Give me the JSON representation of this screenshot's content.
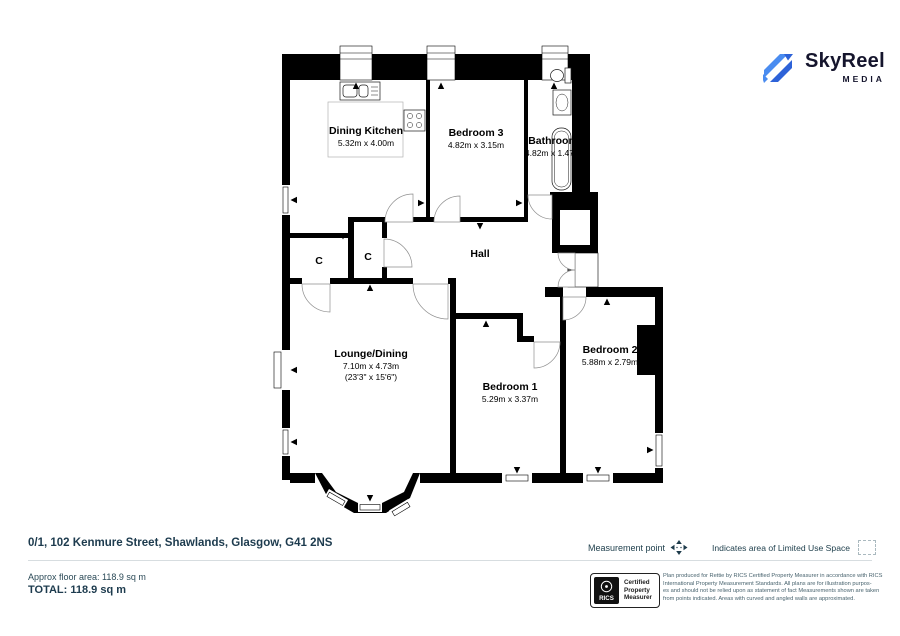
{
  "logo": {
    "brand": "SkyReel",
    "sub": "MEDIA"
  },
  "plan": {
    "dining_kitchen": {
      "name": "Dining Kitchen",
      "dims": "5.32m x 4.00m"
    },
    "bedroom_3": {
      "name": "Bedroom 3",
      "dims": "4.82m x 3.15m"
    },
    "bathroom": {
      "name": "Bathroom",
      "dims": "4.82m x 1.47m"
    },
    "hall": {
      "name": "Hall"
    },
    "cupboard_left": {
      "label": "C"
    },
    "cupboard_right": {
      "label": "C"
    },
    "lounge_dining": {
      "name": "Lounge/Dining",
      "dims": "7.10m x 4.73m",
      "dims_imperial": "(23'3\" x 15'6\")"
    },
    "bedroom_1": {
      "name": "Bedroom 1",
      "dims": "5.29m x 3.37m"
    },
    "bedroom_2": {
      "name": "Bedroom 2",
      "dims": "5.88m x 2.79m"
    }
  },
  "footer": {
    "address": "0/1, 102 Kenmure Street, Shawlands, Glasgow, G41 2NS",
    "approx_area": "Approx floor area: 118.9 sq m",
    "total": "TOTAL: 118.9 sq m",
    "legend": {
      "measurement_point": "Measurement point",
      "limited_use": "Indicates area of  Limited Use Space"
    },
    "rics_badge": {
      "brand": "RICS",
      "lines": [
        "Certified",
        "Property",
        "Measurer"
      ]
    },
    "disclaimer": [
      "Plan produced for Rettie by RICS Certified Property Measurer in accordance with RICS",
      "International Property  Measurement Standards.  All plans are for illustration purpos-",
      "es and should not be relied upon as statement of fact Measurements shown are taken",
      "from points indicated. Areas with curved and angled walls are approximated."
    ]
  },
  "colors": {
    "logo_blue_light": "#4a8cf0",
    "logo_blue_dark": "#2d62d8",
    "logo_text": "#15152d",
    "wall_black": "#000000",
    "footer_text": "#1d3b4e"
  }
}
